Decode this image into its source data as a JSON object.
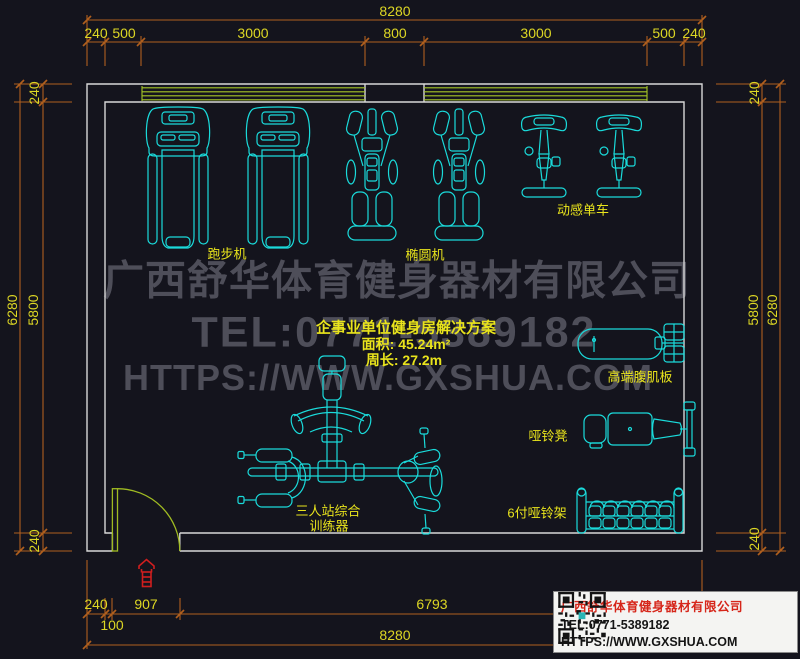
{
  "colors": {
    "background": "#14141d",
    "wall": "#d8d8d8",
    "equipment_cyan": "#1adbdb",
    "label_yellow": "#e9e41c",
    "dimension_orange": "#b05f1e",
    "window_green": "#a6c626",
    "watermark_gray": "#4e4e59",
    "stamp_red": "#d01e1e",
    "card_title_red": "#d6261a"
  },
  "dimensions": {
    "top": {
      "total": "8280",
      "segments": [
        "240",
        "500",
        "3000",
        "800",
        "3000",
        "500",
        "240"
      ]
    },
    "bottom": {
      "segments": [
        "240",
        "907",
        "6793"
      ],
      "offset": "100",
      "total": "8280"
    },
    "left": {
      "total": "6280",
      "segments": [
        "240",
        "5800",
        "240"
      ]
    },
    "right": {
      "total": "6280",
      "segments": [
        "240",
        "5800",
        "240"
      ]
    }
  },
  "labels": {
    "treadmill": "跑步机",
    "elliptical": "椭圆机",
    "spin_bike": "动感单车",
    "ab_board": "高端腹肌板",
    "dumbbell_bench": "哑铃凳",
    "dumbbell_rack": "6付哑铃架",
    "multi_station_line1": "三人站综合",
    "multi_station_line2": "训练器"
  },
  "info": {
    "title": "企事业单位健身房解决方案",
    "area": "面积: 45.24m²",
    "perimeter": "周长: 27.2m"
  },
  "watermark": {
    "company": "广西舒华体育健身器材有限公司",
    "tel": "TEL:0771-5389182",
    "url": "HTTPS://WWW.GXSHUA.COM"
  },
  "card": {
    "company": "广西舒华体育健身器材有限公司",
    "tel": "TEL:0771-5389182",
    "url": "HTTPS://WWW.GXSHUA.COM"
  }
}
